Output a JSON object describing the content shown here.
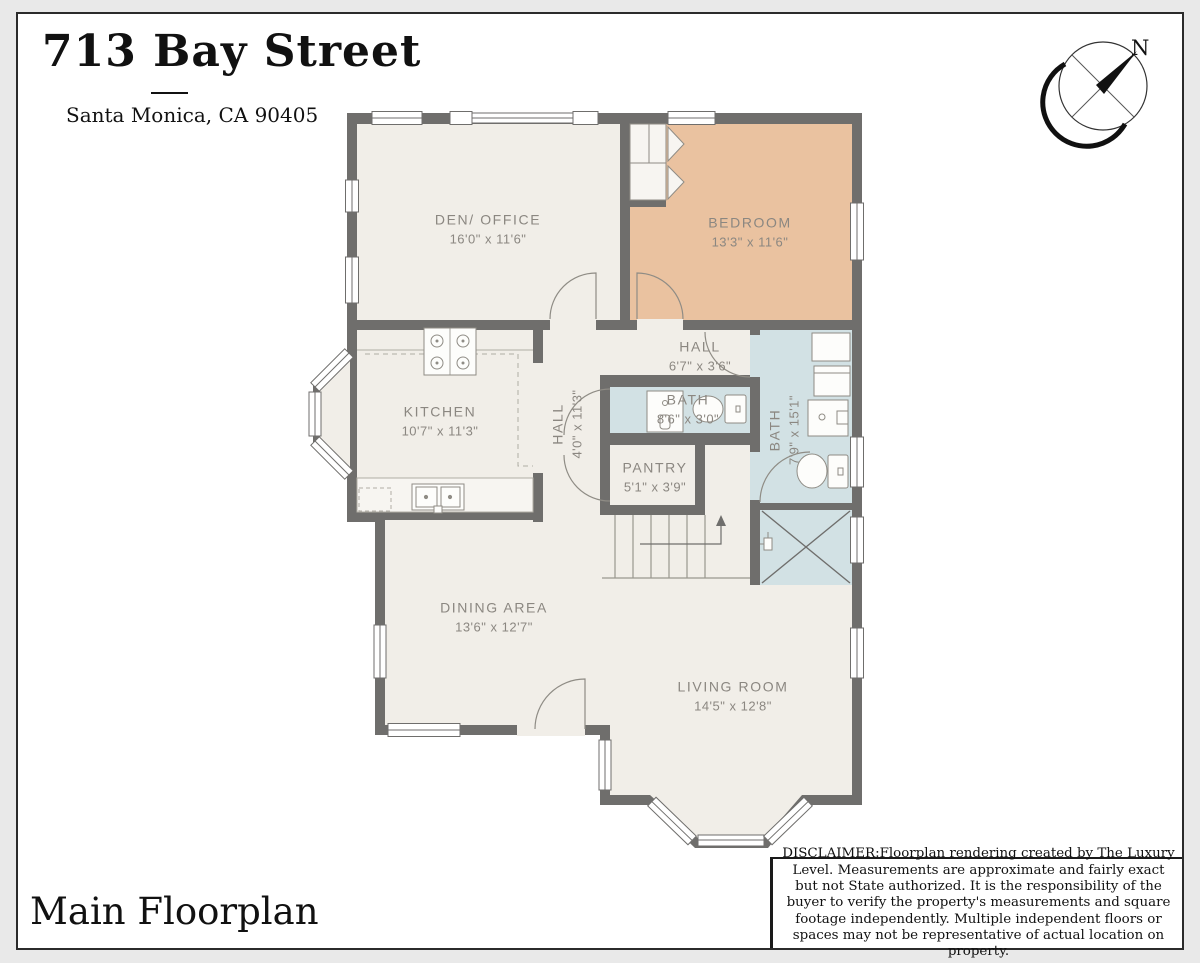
{
  "header": {
    "title": "713 Bay Street",
    "subtitle": "Santa Monica, CA 90405"
  },
  "compass": {
    "north_label": "N"
  },
  "rooms": [
    {
      "id": "den-office",
      "name": "DEN/ OFFICE",
      "dims": "16'0\" x 11'6\""
    },
    {
      "id": "bedroom",
      "name": "BEDROOM",
      "dims": "13'3\" x 11'6\""
    },
    {
      "id": "hall-upper",
      "name": "HALL",
      "dims": "6'7\" x 3'6\""
    },
    {
      "id": "kitchen",
      "name": "KITCHEN",
      "dims": "10'7\" x 11'3\""
    },
    {
      "id": "hall-lower",
      "name": "HALL",
      "dims": "4'0\" x 11'3\""
    },
    {
      "id": "bath-small",
      "name": "BATH",
      "dims": "8'6\" x 3'0\""
    },
    {
      "id": "bath-large",
      "name": "BATH",
      "dims": "7'9\" x 15'1\""
    },
    {
      "id": "pantry",
      "name": "PANTRY",
      "dims": "5'1\" x 3'9\""
    },
    {
      "id": "dining-area",
      "name": "DINING AREA",
      "dims": "13'6\" x 12'7\""
    },
    {
      "id": "living-room",
      "name": "LIVING ROOM",
      "dims": "14'5\" x 12'8\""
    }
  ],
  "footer": {
    "plan_title": "Main Floorplan",
    "disclaimer": "DISCLAIMER:Floorplan rendering created by The Luxury Level. Measurements are approximate and fairly exact but not State authorized. It is the responsibility of the buyer to verify the property's measurements and square footage independently.  Multiple independent floors or spaces may not be representative of actual location on property."
  },
  "colors": {
    "wall": "#6f6e6c",
    "floor": "#f1eee8",
    "bedroom_floor": "#eac2a0",
    "bath_floor": "#d2e1e4",
    "label_text": "#8b8781",
    "page_border": "#2b2b2b"
  }
}
